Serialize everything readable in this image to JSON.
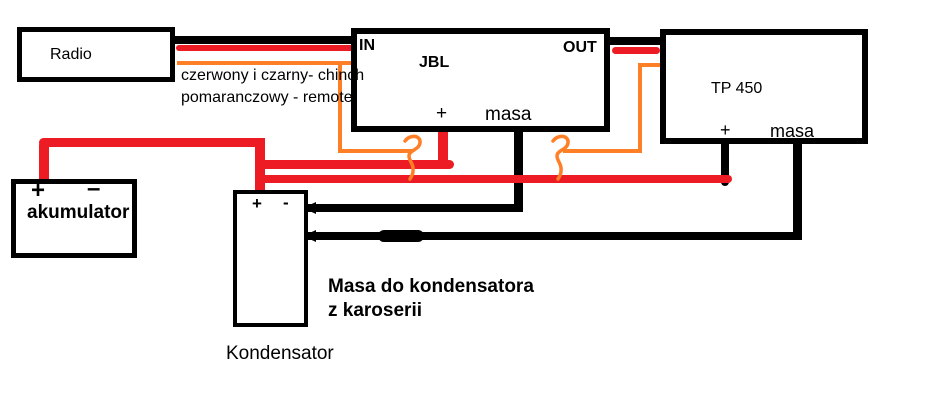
{
  "colors": {
    "wire_power_red": "#ed1c24",
    "wire_remote_orange": "#ff7f27",
    "wire_ground_black": "#000000",
    "background": "#ffffff"
  },
  "devices": {
    "radio": {
      "label": "Radio"
    },
    "jbl_amp": {
      "label": "JBL",
      "input": "IN",
      "output": "OUT",
      "plus": "+",
      "ground": "masa"
    },
    "tp450_amp": {
      "label": "TP 450",
      "plus": "+",
      "ground": "masa"
    },
    "battery": {
      "label": "akumulator",
      "plus": "+",
      "minus": "–"
    },
    "capacitor": {
      "label": "Kondensator",
      "plus": "+",
      "minus": "-"
    }
  },
  "annotations": {
    "rca_note_line1": "czerwony i czarny- chinch",
    "rca_note_line2": "pomaranczowy - remote",
    "ground_note_line1": "Masa do kondensatora",
    "ground_note_line2": "z karoserii"
  }
}
